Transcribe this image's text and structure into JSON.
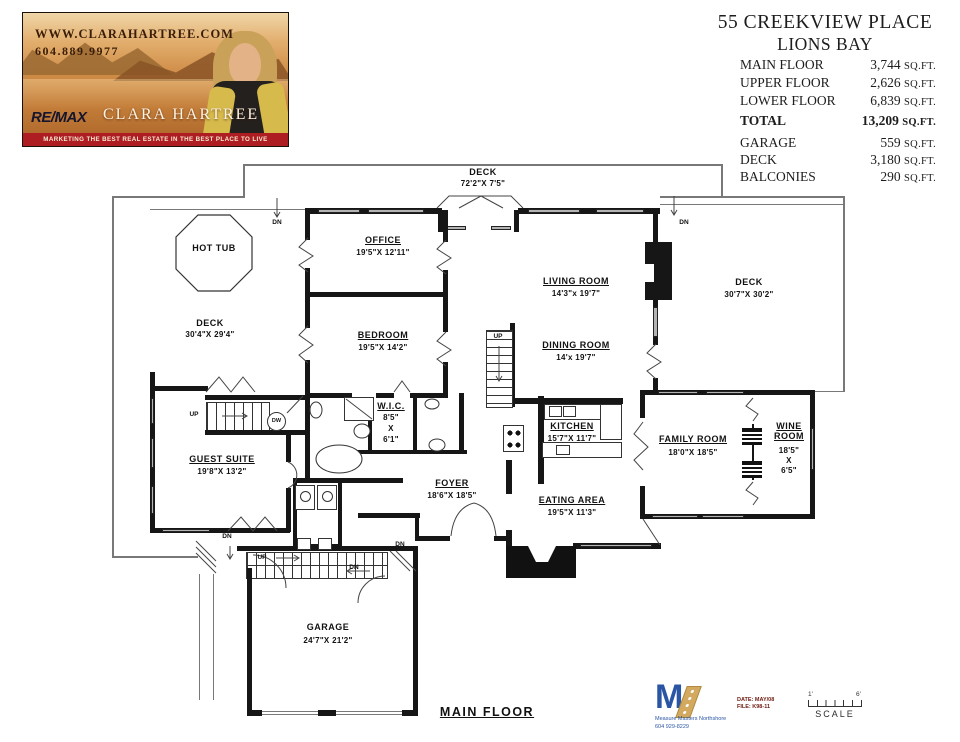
{
  "header": {
    "card": {
      "website": "WWW.CLARAHARTREE.COM",
      "phone": "604.889.9977",
      "brand": "RE/MAX",
      "agent": "CLARA HARTREE",
      "tagline": "MARKETING THE BEST REAL ESTATE IN THE BEST PLACE TO LIVE",
      "colors": {
        "band": "#ad1d22",
        "photo_warm": "#cd8a44",
        "text_dark": "#3a1d07"
      }
    },
    "property": {
      "title_line1": "55 CREEKVIEW PLACE",
      "title_line2": "LIONS BAY",
      "area_rows": [
        {
          "label": "MAIN FLOOR",
          "value": "3,744",
          "unit": "SQ.FT."
        },
        {
          "label": "UPPER FLOOR",
          "value": "2,626",
          "unit": "SQ.FT."
        },
        {
          "label": "LOWER FLOOR",
          "value": "6,839",
          "unit": "SQ.FT."
        }
      ],
      "total_row": {
        "label": "TOTAL",
        "value": "13,209",
        "unit": "SQ.FT."
      },
      "extra_rows": [
        {
          "label": "GARAGE",
          "value": "559",
          "unit": "SQ.FT."
        },
        {
          "label": "DECK",
          "value": "3,180",
          "unit": "SQ.FT."
        },
        {
          "label": "BALCONIES",
          "value": "290",
          "unit": "SQ.FT."
        }
      ]
    }
  },
  "plan": {
    "floor_label": "MAIN FLOOR",
    "rooms": [
      {
        "name": "DECK",
        "dims": "72'2\"X  7'5\""
      },
      {
        "name": "HOT  TUB"
      },
      {
        "name": "OFFICE",
        "dims": "19'5\"X  12'11\""
      },
      {
        "name": "LIVING  ROOM",
        "dims": "14'3\"x 19'7\""
      },
      {
        "name": "DECK",
        "dims": "30'7\"X  30'2\""
      },
      {
        "name": "DECK",
        "dims": "30'4\"X  29'4\""
      },
      {
        "name": "BEDROOM",
        "dims": "19'5\"X  14'2\""
      },
      {
        "name": "DINING ROOM",
        "dims": "14'x 19'7\""
      },
      {
        "name": "W.I.C.",
        "dims": "8'5\"",
        "dims2": "X",
        "dims3": "6'1\""
      },
      {
        "name": "KITCHEN",
        "dims": "15'7\"X  11'7\""
      },
      {
        "name": "FAMILY  ROOM",
        "dims": "18'0\"X  18'5\""
      },
      {
        "name": "WINE ROOM",
        "dims": "18'5\"",
        "dims2": "X",
        "dims3": "6'5\""
      },
      {
        "name": "GUEST  SUITE",
        "dims": "19'8\"X  13'2\""
      },
      {
        "name": "FOYER",
        "dims": "18'6\"X  18'5\""
      },
      {
        "name": "EATING  AREA",
        "dims": "19'5\"X  11'3\""
      },
      {
        "name": "GARAGE",
        "dims": "24'7\"X  21'2\""
      }
    ],
    "glyphs": {
      "up": "UP",
      "dn": "DN",
      "dw": "DW"
    }
  },
  "footer": {
    "surveyor": {
      "logo_letter": "M",
      "name": "Measure Masters Northshore",
      "phone": "604 929-8229"
    },
    "stamp": {
      "date": "DATE: MAY/08",
      "file": "FILE: K98-11"
    },
    "scale": {
      "label": "SCALE",
      "left_tick": "1'",
      "right_tick": "6'"
    }
  }
}
